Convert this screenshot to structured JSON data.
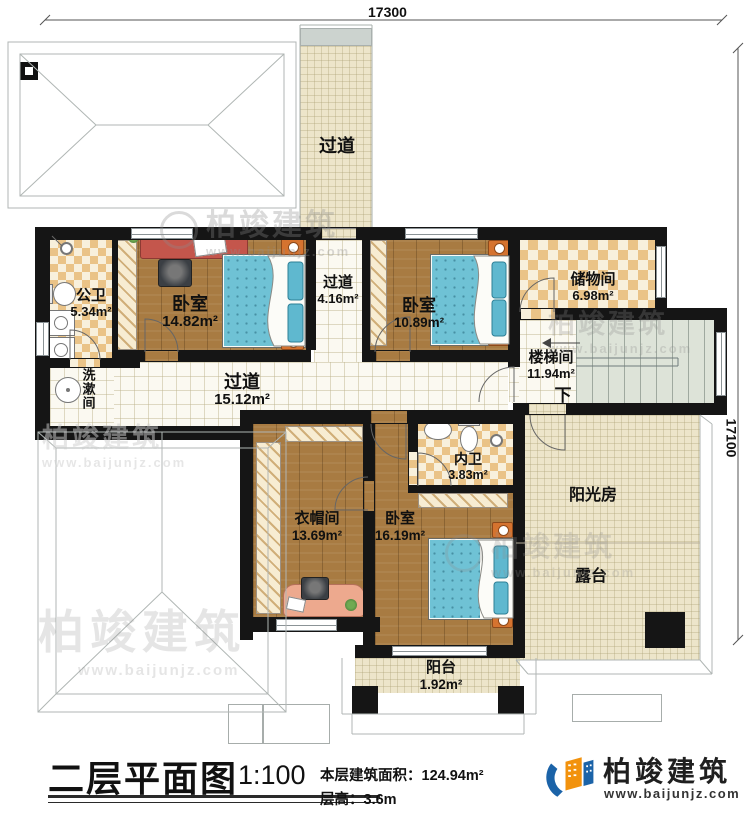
{
  "dimensions": {
    "top": "17300",
    "right": "17100"
  },
  "rooms": {
    "corridor_top": {
      "name": "过道"
    },
    "public_bath": {
      "name": "公卫",
      "area": "5.34m²"
    },
    "bedroom1": {
      "name": "卧室",
      "area": "14.82m²"
    },
    "corridor_mid": {
      "name": "过道",
      "area": "4.16m²"
    },
    "bedroom2": {
      "name": "卧室",
      "area": "10.89m²"
    },
    "storage": {
      "name": "储物间",
      "area": "6.98m²"
    },
    "stairwell": {
      "name": "楼梯间",
      "area": "11.94m²",
      "down": "下"
    },
    "washroom": {
      "name": "洗漱间"
    },
    "corridor_main": {
      "name": "过道",
      "area": "15.12m²"
    },
    "cloakroom": {
      "name": "衣帽间",
      "area": "13.69m²"
    },
    "bedroom3": {
      "name": "卧室",
      "area": "16.19m²"
    },
    "ensuite_bath": {
      "name": "内卫",
      "area": "3.83m²"
    },
    "balcony": {
      "name": "阳台",
      "area": "1.92m²"
    },
    "sunroom": {
      "name": "阳光房"
    },
    "terrace": {
      "name": "露台"
    }
  },
  "titleblock": {
    "title": "二层平面图",
    "scale": "1:100",
    "area_label": "本层建筑面积：",
    "area_value": "124.94m²",
    "floor_height_label": "层高：",
    "floor_height_value": "3.6m"
  },
  "brand": {
    "name": "柏竣建筑",
    "website": "www.baijunjz.com"
  },
  "colors": {
    "wall": "#151515",
    "wood": "#a87b42",
    "tile": "#eac387",
    "bed": "#6fc2d5",
    "outdoor": "#ede5ca",
    "stairs": "#dde3d8",
    "brand_blue": "#1b63a8",
    "brand_orange": "#f2920d"
  }
}
